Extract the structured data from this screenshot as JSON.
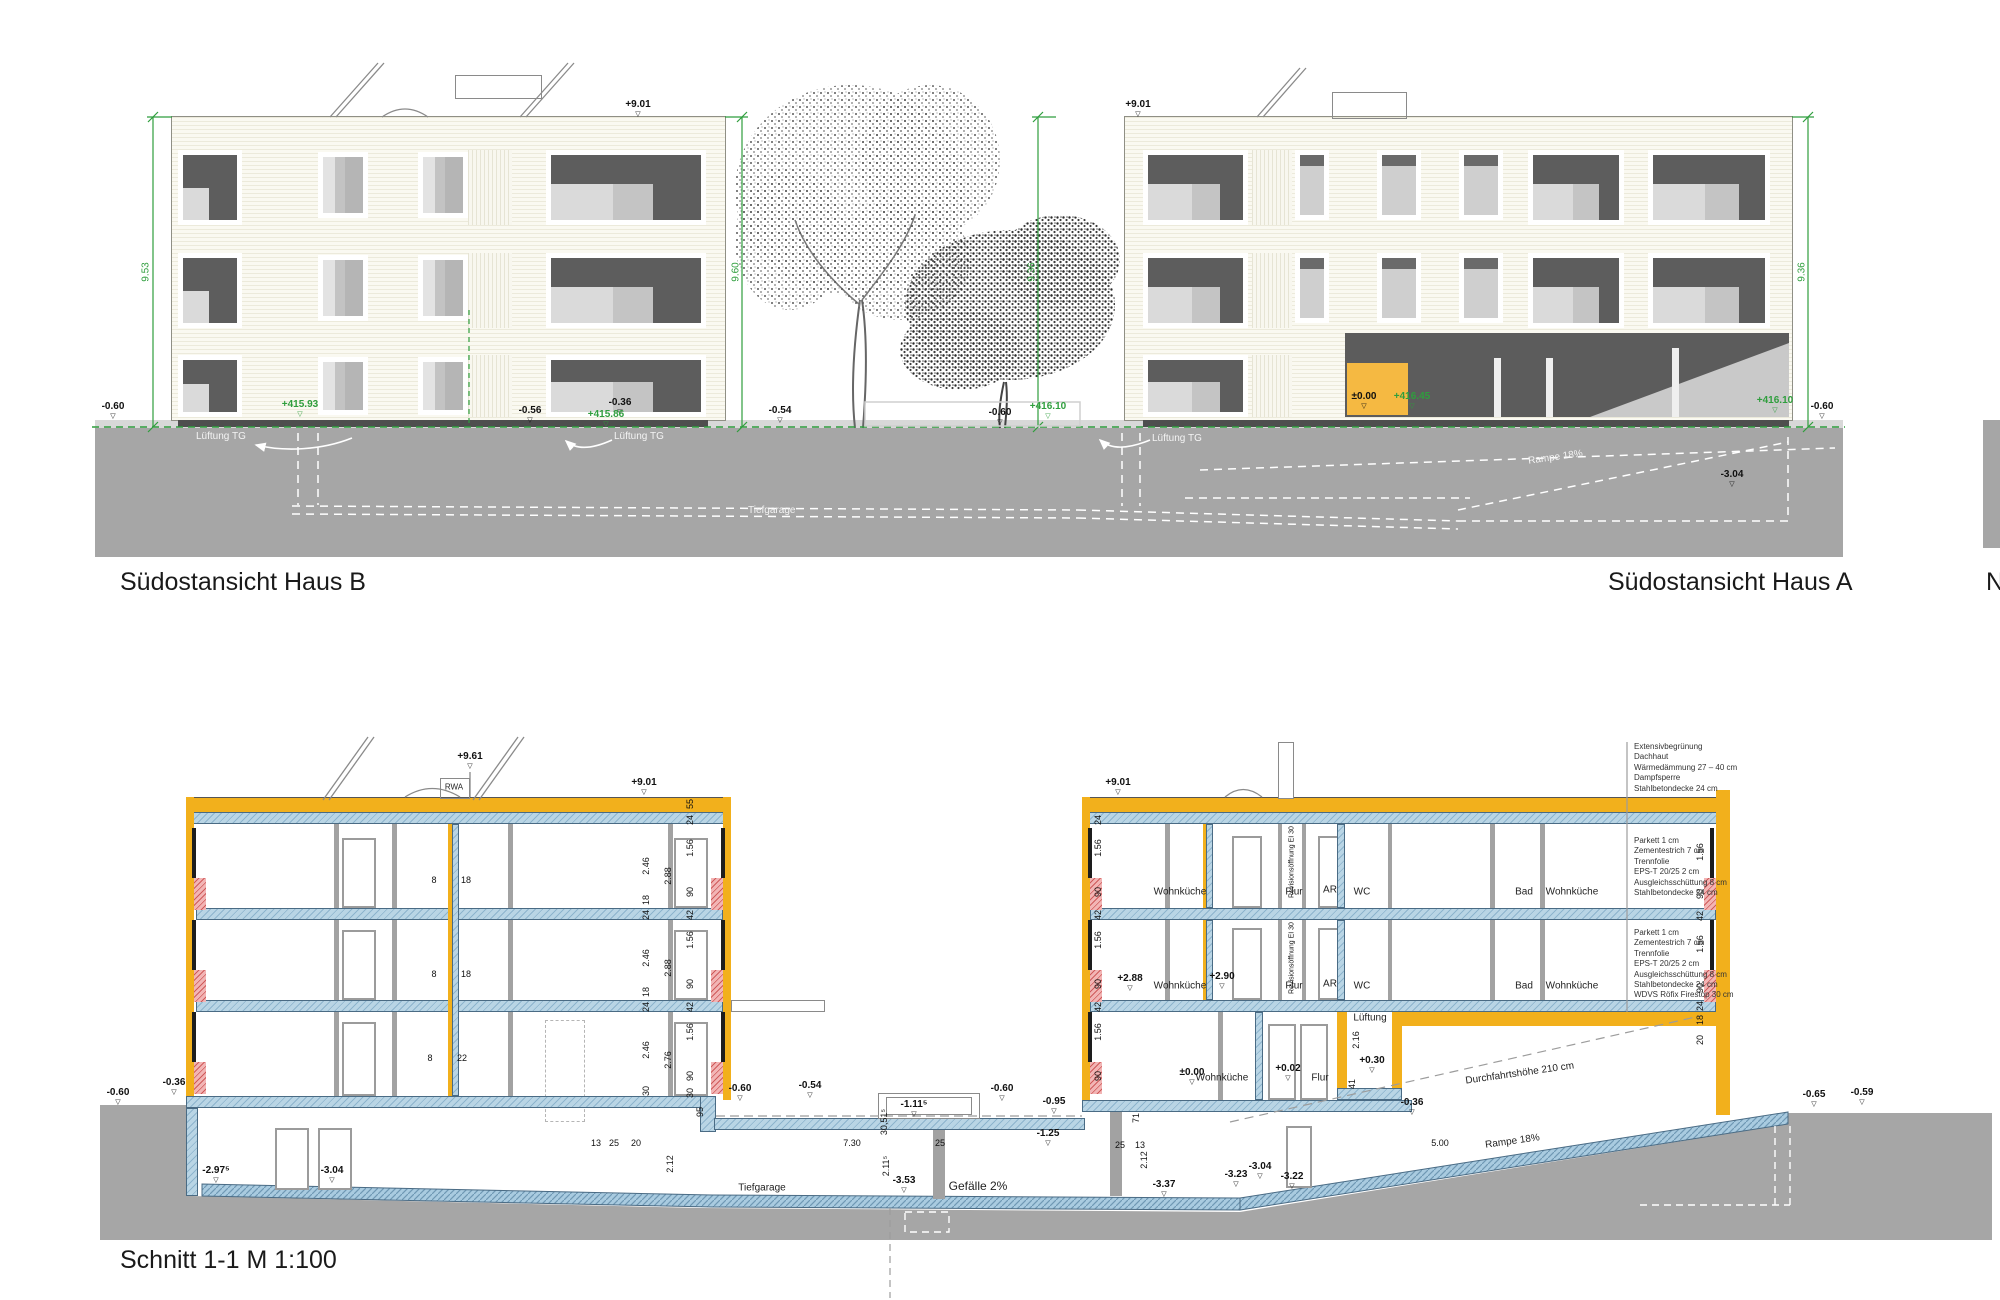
{
  "titles": {
    "b": "Südostansicht Haus B",
    "a": "Südostansicht Haus A",
    "section": "Schnitt 1-1   M 1:100",
    "partial": "N"
  },
  "elevation": {
    "peaks": {
      "b": "+9.01",
      "a": "+9.01"
    },
    "dims": {
      "b_left": "9.53",
      "b_right": "9.60",
      "a_left": "9.36",
      "a_right": "9.36"
    },
    "levels": {
      "g_left": "-0.60",
      "b_footing": "+415.93",
      "b_base1": "-0.56",
      "b_base2": "-0.36",
      "b_right": "+415.86",
      "mid": "-0.54",
      "a_left_g": "-0.60",
      "a_left": "+416.10",
      "zero": "±0.00",
      "abs_zero": "+416.45",
      "a_right": "+416.10",
      "a_right_g": "-0.60",
      "garage": "-3.04"
    },
    "labels": {
      "lueftung": "Lüftung TG",
      "tiefgarage": "Tiefgarage",
      "rampe": "Rampe 18%"
    }
  },
  "section": {
    "levels": {
      "roof_peak": "+9.61",
      "parapet_b": "+9.01",
      "parapet_a": "+9.01",
      "f2": "+2.88",
      "f2_flur": "+2.90",
      "gf": "±0.00",
      "gf_flur": "+0.02",
      "shaft_top": "+0.30",
      "court1": "-0.60",
      "court2": "-0.54",
      "court3": "-0.60",
      "court4": "-0.95",
      "court5": "-1.25",
      "garage_top": "-1.11⁵",
      "bsmt1": "-2.97⁵",
      "bsmt2": "-3.04",
      "garage": "-3.53",
      "ramp1": "-3.37",
      "ramp2": "-3.23",
      "ramp3": "-3.04",
      "ramp4": "-3.22",
      "ramp_mid": "-0.36",
      "right1": "-0.65",
      "right2": "-0.59",
      "base_l1": "-0.60",
      "base_l2": "-0.36"
    },
    "dims": {
      "d55": "55",
      "d24": "24",
      "d18": "18",
      "d156": "1.56",
      "d90": "90",
      "d42": "42",
      "d246": "2.46",
      "d288": "2.88",
      "d276": "2.76",
      "d30": "30",
      "d95": "95",
      "d212": "2.12",
      "d216": "2.16",
      "d41": "41",
      "d71": "71",
      "d2115": "2.11⁵",
      "d30515": "30,51⁵",
      "d13": "13",
      "d25": "25",
      "d20": "20",
      "d730": "7.30",
      "d500": "5.00",
      "d8": "8",
      "d22": "22"
    },
    "rooms": {
      "wohnkueche": "Wohnküche",
      "flur": "Flur",
      "ar": "AR",
      "wc": "WC",
      "bad": "Bad",
      "lueftung": "Lüftung",
      "tiefgarage": "Tiefgarage"
    },
    "labels": {
      "gefaelle": "Gefälle 2%",
      "rampe": "Rampe 18%",
      "durchfahrt": "Durchfahrtshöhe 210 cm",
      "revision": "Revisionsöffnung EI 30",
      "rwa": "RWA"
    },
    "notes": {
      "roof": [
        "Extensivbegrünung",
        "Dachhaut",
        "Wärmedämmung 27 – 40 cm",
        "Dampfsperre",
        "Stahlbetondecke 24 cm"
      ],
      "floor": [
        "Parkett  1 cm",
        "Zementestrich  7 cm",
        "Trennfolie",
        "EPS-T 20/25  2 cm",
        "Ausgleichsschüttung  8 cm",
        "Stahlbetondecke 24 cm"
      ],
      "floor2": [
        "Parkett  1 cm",
        "Zementestrich  7 cm",
        "Trennfolie",
        "EPS-T 20/25  2 cm",
        "Ausgleichsschüttung  8 cm",
        "Stahlbetondecke 24 cm",
        "WDVS Röfix Firestop 30 cm"
      ]
    }
  }
}
